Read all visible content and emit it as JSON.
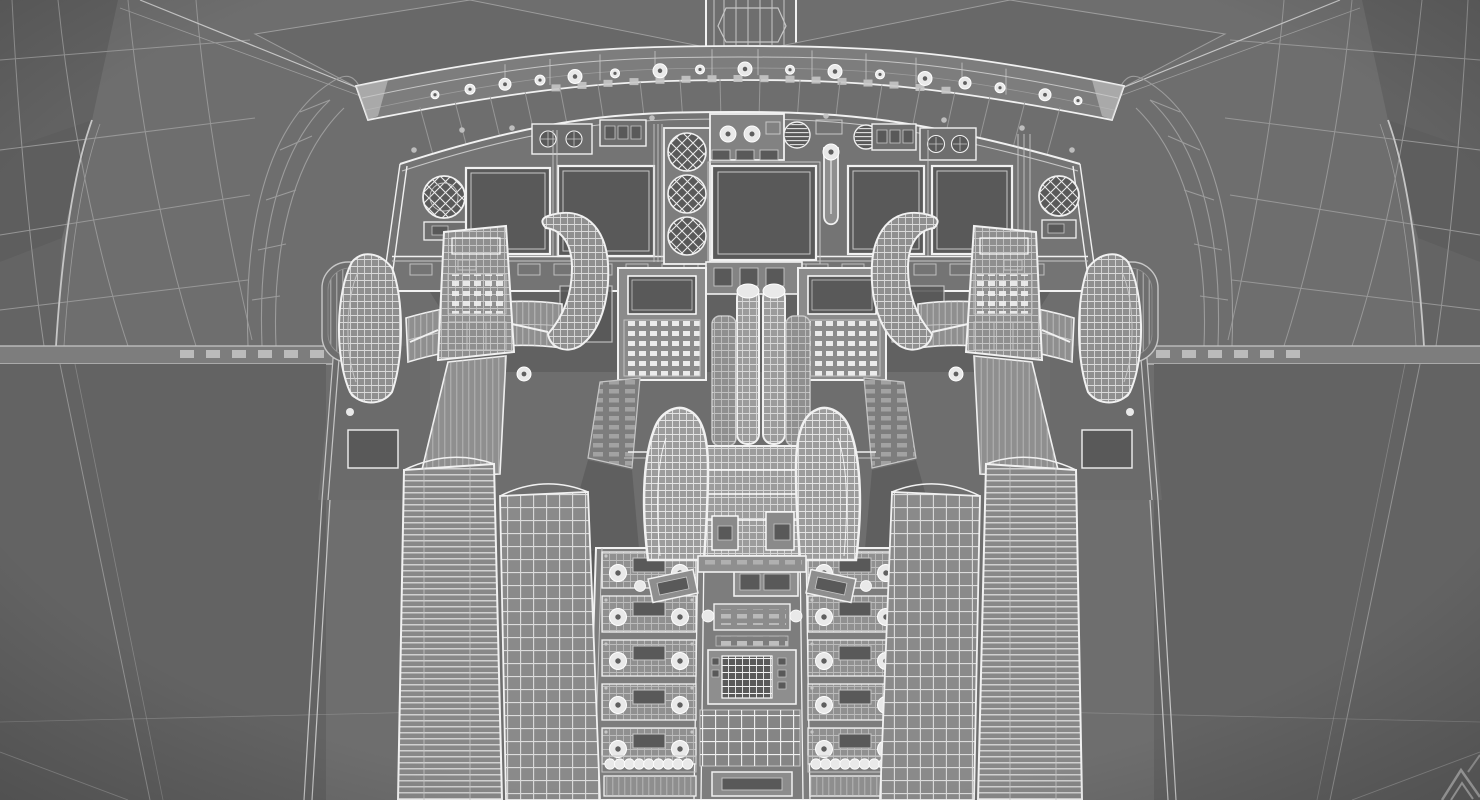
{
  "meta": {
    "kind": "3d-wireframe-viewport",
    "subject": "Airliner cockpit interior, quad wireframe render, centered front view",
    "render_mode": "wireframe",
    "text_visible": "none"
  },
  "canvas": {
    "width_px": 1480,
    "height_px": 800
  },
  "palette": {
    "bg": "#6e6e6e",
    "windshield": "#686868",
    "wall": "#636363",
    "facetDark": "#545454",
    "panel": "#747474",
    "band": "#7d7d7d",
    "screen": "#595959",
    "equip": "#8f8f8f",
    "equipBright": "#9c9c9c",
    "lineDim": "#9c9c9c",
    "lineMid": "#c6c6c6",
    "lineBright": "#f1f1f1",
    "knob": "#e9e9e9",
    "knobDot": "#5f5f5f",
    "watermark": "#ababab"
  },
  "watermark": {
    "icon": "chevron-logo-icon",
    "position": "bottom-right"
  },
  "components": {
    "ceiling": "cabin ceiling and windshield center post",
    "glareshield": "glareshield / mode-control panel strip with rows of knobs",
    "main_panel": "main instrument panel with five dark flight displays",
    "standby_gauges": "cross-hatched wireframe standby gauges (left, center stack of three, right)",
    "yokes": [
      "captain-control-yoke",
      "first-officer-control-yoke"
    ],
    "cdus": [
      "left-cdu-keypad",
      "right-cdu-keypad"
    ],
    "throttle_quadrant": "center throttle quadrant with twin thrust levers",
    "aft_pedestal": "aft pedestal with radio panels, keypad and grid plate",
    "sidewalls": [
      "left-sidewall",
      "right-sidewall"
    ]
  },
  "pedestal": {
    "radio_rows_per_column": 5,
    "knobs_per_radio_row": 2,
    "bead_knob_count": 9
  },
  "glareshield_cfg": {
    "large_knob_xs": [
      575,
      660,
      745,
      835,
      925
    ],
    "small_knob_xs": [
      615,
      700,
      790,
      880
    ],
    "wing_knobs": [
      [
        505,
        6
      ],
      [
        540,
        5
      ],
      [
        470,
        5
      ],
      [
        435,
        4
      ],
      [
        965,
        6
      ],
      [
        1000,
        5
      ],
      [
        1045,
        6
      ],
      [
        1078,
        4
      ]
    ],
    "divider_xs": [
      505,
      550,
      600,
      655,
      712,
      758,
      812,
      866,
      916,
      962,
      1006
    ],
    "strut_xs": [
      420,
      455,
      490,
      525,
      560,
      598,
      640,
      680,
      720,
      760,
      800,
      840,
      882,
      920,
      955,
      990,
      1025,
      1060
    ]
  }
}
